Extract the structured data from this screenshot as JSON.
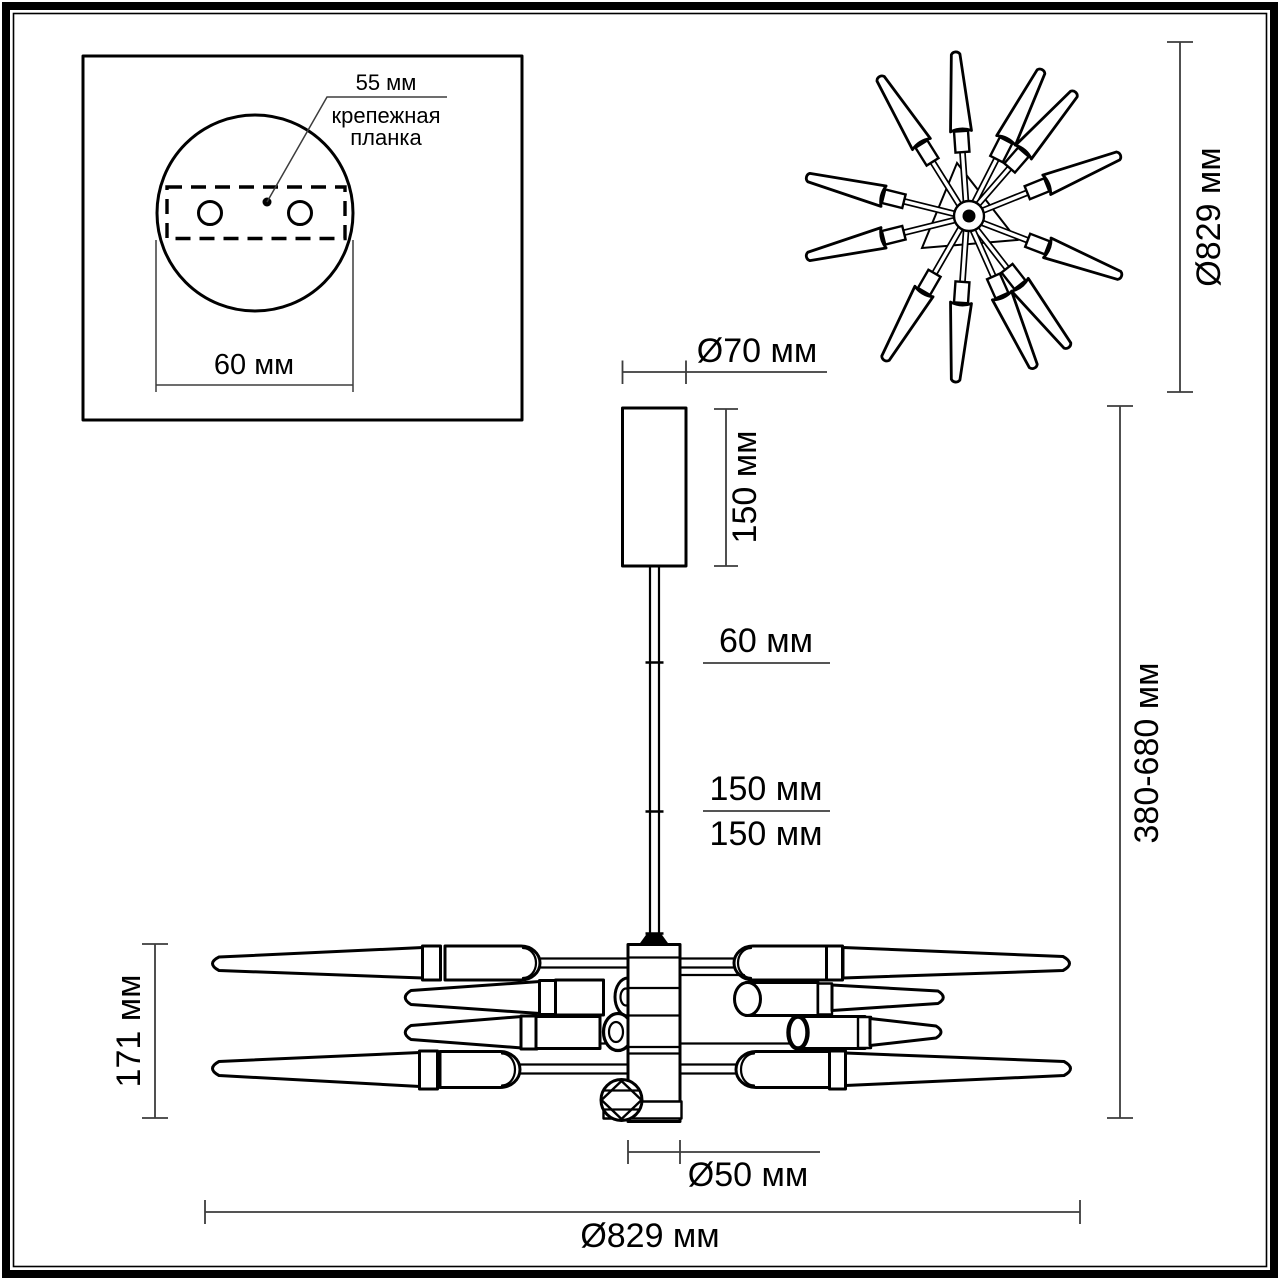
{
  "colors": {
    "ink": "#000000",
    "dim_line": "#3d3d3d",
    "paper": "#ffffff"
  },
  "inset": {
    "hole_spacing_label": "55 мм",
    "bracket_label_line1": "крепежная",
    "bracket_label_line2": "планка",
    "plate_width_label": "60 мм"
  },
  "top_view": {
    "diameter_label": "Ø829 мм"
  },
  "side_view": {
    "canopy_diameter_label": "Ø70 мм",
    "canopy_height_label": "150 мм",
    "rod_segment_60_label": "60 мм",
    "rod_segment_150a_label": "150 мм",
    "rod_segment_150b_label": "150 мм",
    "height_range_label": "380-680 мм",
    "body_height_label": "171 мм",
    "hub_diameter_label": "Ø50 мм",
    "overall_diameter_label": "Ø829 мм"
  }
}
